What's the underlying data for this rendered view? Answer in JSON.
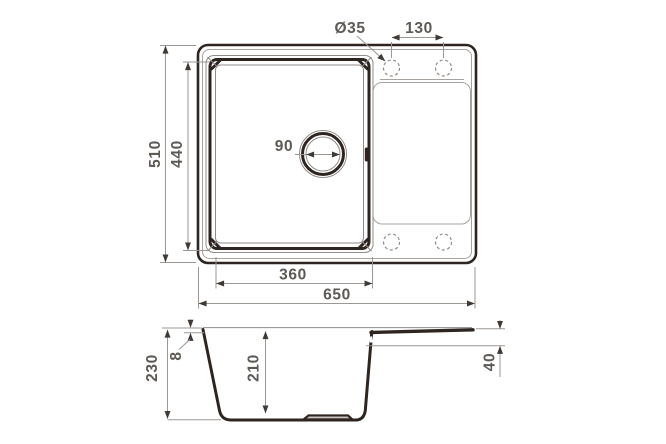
{
  "drawing": {
    "title": "sink-technical-drawing",
    "top_view": {
      "tap_hole_diameter": "Ø35",
      "tap_hole_spacing": "130",
      "overall_width": "650",
      "overall_depth": "510",
      "bowl_width": "360",
      "bowl_depth": "440",
      "drain_diameter": "90"
    },
    "section_view": {
      "overall_height": "230",
      "rim_thickness": "8",
      "bowl_height": "210",
      "drainboard_height": "40"
    },
    "colors": {
      "object_line": "#2e2521",
      "thin_line": "#918c88",
      "dimension_line": "#9b9793",
      "arrow": "#3f3a36",
      "text": "#5d5955",
      "background": "#ffffff"
    }
  }
}
